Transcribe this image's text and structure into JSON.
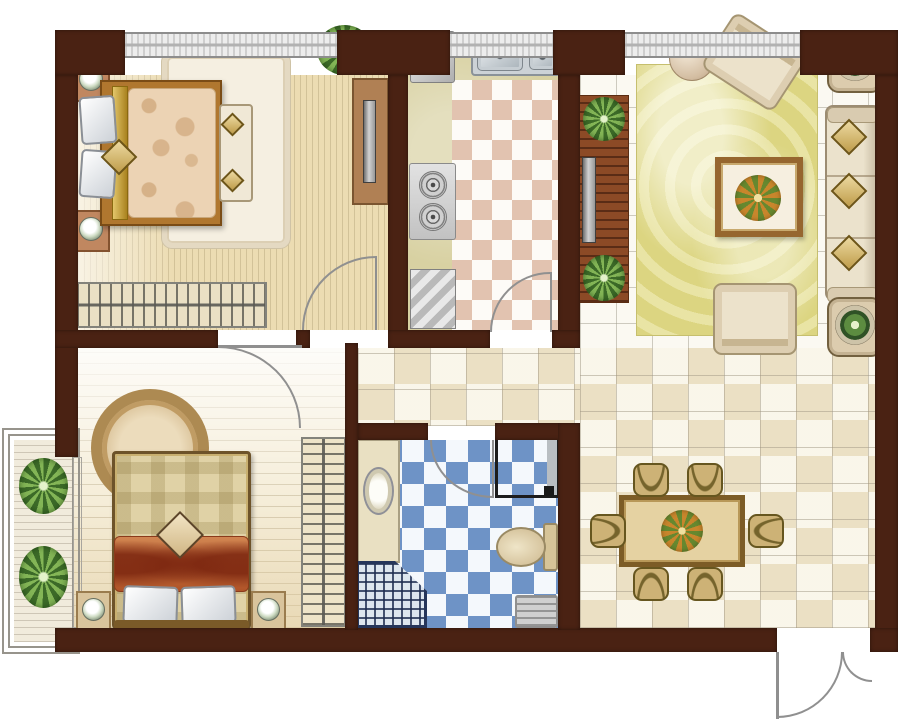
{
  "meta": {
    "name": "apartment-floor-plan",
    "canvas": {
      "width": 900,
      "height": 727
    },
    "background": "#ffffff"
  },
  "palette": {
    "wall": "#4a2213",
    "door_arc": "#909090",
    "tile_white": "#fbf9f2",
    "tile_warm": "#f7f2e3",
    "bath_tile_blue": "#6e93c6",
    "kitchen_tile_pink": "#e2c3b0",
    "wood_floor": "#ecdcb2",
    "living_rug_yellow": "#dcd581",
    "bed_wood": "#b0772f",
    "shelf_wood": "#8c4a26",
    "plant_green": "#83b556"
  },
  "rooms": [
    {
      "name": "bedroom-1",
      "position": "top-left"
    },
    {
      "name": "kitchen",
      "position": "top-middle"
    },
    {
      "name": "living-room",
      "position": "top-right"
    },
    {
      "name": "bedroom-2",
      "position": "bottom-left"
    },
    {
      "name": "bathroom",
      "position": "bottom-middle"
    },
    {
      "name": "dining-area",
      "position": "bottom-right"
    },
    {
      "name": "balcony",
      "position": "left"
    },
    {
      "name": "hallway",
      "position": "center"
    }
  ],
  "elements": [
    {
      "n": "bedroom1-floor",
      "c": "bed1-floor",
      "x": 78,
      "y": 75,
      "w": 310,
      "h": 255
    },
    {
      "n": "kitchen-counter-base",
      "c": "counter",
      "x": 408,
      "y": 58,
      "w": 150,
      "h": 272
    },
    {
      "n": "kitchen-floor",
      "c": "kitchen-floor",
      "x": 452,
      "y": 80,
      "w": 106,
      "h": 250
    },
    {
      "n": "living-room-floor",
      "c": "tiles",
      "x": 580,
      "y": 75,
      "w": 295,
      "h": 285
    },
    {
      "n": "hallway-floor",
      "c": "tiles-warm",
      "x": 358,
      "y": 348,
      "w": 224,
      "h": 78
    },
    {
      "n": "dining-floor",
      "c": "tiles-warm",
      "x": 580,
      "y": 348,
      "w": 295,
      "h": 280
    },
    {
      "n": "bedroom2-floor",
      "c": "bed2-floor",
      "x": 55,
      "y": 348,
      "w": 292,
      "h": 280
    },
    {
      "n": "bathroom-floor",
      "c": "bath-floor",
      "x": 358,
      "y": 440,
      "w": 200,
      "h": 188
    },
    {
      "n": "balcony-frame-outer",
      "c": "frame",
      "x": 2,
      "y": 428,
      "w": 78,
      "h": 226
    },
    {
      "n": "balcony-frame-inner",
      "c": "frame",
      "x": 8,
      "y": 434,
      "w": 66,
      "h": 214
    },
    {
      "n": "balcony-deck",
      "c": "deck",
      "x": 14,
      "y": 440,
      "w": 58,
      "h": 202
    },
    {
      "n": "balcony-window-line",
      "c": "frame-thin",
      "x": 73,
      "y": 457,
      "w": 9,
      "h": 171
    },
    {
      "n": "bedroom1-rug",
      "c": "rug-white",
      "x": 162,
      "y": 52,
      "w": 128,
      "h": 196
    },
    {
      "n": "living-room-rug",
      "c": "rug-lr",
      "x": 636,
      "y": 64,
      "w": 182,
      "h": 272
    },
    {
      "n": "bedroom2-round-rug",
      "c": "rug-round",
      "x": 91,
      "y": 389,
      "w": 118,
      "h": 118
    },
    {
      "n": "bedroom1-nightstand-top",
      "c": "nightstand",
      "x": 72,
      "y": 60,
      "w": 38,
      "h": 42
    },
    {
      "n": "bedroom1-lamp-top",
      "c": "lamp",
      "x": 79,
      "y": 67,
      "w": 24,
      "h": 24
    },
    {
      "n": "bedroom1-nightstand-bottom",
      "c": "nightstand",
      "x": 72,
      "y": 210,
      "w": 38,
      "h": 42
    },
    {
      "n": "bedroom1-lamp-bottom",
      "c": "lamp",
      "x": 79,
      "y": 217,
      "w": 24,
      "h": 24
    },
    {
      "n": "bedroom1-bed-frame",
      "c": "bed-frame",
      "x": 100,
      "y": 80,
      "w": 122,
      "h": 146
    },
    {
      "n": "bedroom1-bed-trim",
      "c": "gold",
      "x": 112,
      "y": 86,
      "w": 16,
      "h": 134
    },
    {
      "n": "bedroom1-duvet",
      "c": "duvet",
      "x": 128,
      "y": 88,
      "w": 88,
      "h": 130
    },
    {
      "n": "bedroom1-pillow-top",
      "c": "pillow",
      "x": 80,
      "y": 96,
      "w": 36,
      "h": 48,
      "r": -4
    },
    {
      "n": "bedroom1-pillow-bottom",
      "c": "pillow",
      "x": 80,
      "y": 150,
      "w": 36,
      "h": 48,
      "r": 4
    },
    {
      "n": "bedroom1-cushion",
      "c": "diamond",
      "x": 106,
      "y": 144,
      "w": 26,
      "h": 26,
      "r": 45
    },
    {
      "n": "bedroom1-bench",
      "c": "bench",
      "x": 219,
      "y": 104,
      "w": 34,
      "h": 98
    },
    {
      "n": "bedroom1-bench-cushion-top",
      "c": "diamond",
      "x": 224,
      "y": 116,
      "w": 17,
      "h": 17,
      "r": 45
    },
    {
      "n": "bedroom1-bench-cushion-bottom",
      "c": "diamond",
      "x": 224,
      "y": 172,
      "w": 17,
      "h": 17,
      "r": 45
    },
    {
      "n": "bedroom1-wardrobe",
      "c": "wardrobe-h",
      "x": 75,
      "y": 282,
      "w": 192,
      "h": 46
    },
    {
      "n": "bedroom1-plant",
      "c": "plant",
      "x": 317,
      "y": 25,
      "w": 55,
      "h": 50
    },
    {
      "n": "bedroom1-tv-console",
      "c": "console",
      "x": 352,
      "y": 78,
      "w": 37,
      "h": 127
    },
    {
      "n": "bedroom1-tv",
      "c": "tv",
      "x": 363,
      "y": 100,
      "w": 13,
      "h": 83
    },
    {
      "n": "kitchen-fridge",
      "c": "appliance",
      "x": 410,
      "y": 31,
      "w": 45,
      "h": 52
    },
    {
      "n": "kitchen-sink-unit",
      "c": "sink-unit",
      "x": 471,
      "y": 32,
      "w": 90,
      "h": 44
    },
    {
      "n": "kitchen-sink-basin-left",
      "c": "basin",
      "x": 477,
      "y": 37,
      "w": 46,
      "h": 34
    },
    {
      "n": "kitchen-sink-basin-right",
      "c": "basin",
      "x": 529,
      "y": 40,
      "w": 27,
      "h": 30
    },
    {
      "n": "kitchen-faucet",
      "c": "faucet",
      "x": 521,
      "y": 34,
      "w": 3,
      "h": 22
    },
    {
      "n": "kitchen-stove",
      "c": "stove",
      "x": 409,
      "y": 163,
      "w": 47,
      "h": 77
    },
    {
      "n": "kitchen-burner-top",
      "c": "burner",
      "x": 419,
      "y": 171,
      "w": 28,
      "h": 28
    },
    {
      "n": "kitchen-burner-bottom",
      "c": "burner",
      "x": 419,
      "y": 203,
      "w": 28,
      "h": 28
    },
    {
      "n": "kitchen-dishwasher",
      "c": "appliance-slant",
      "x": 410,
      "y": 269,
      "w": 46,
      "h": 60
    },
    {
      "n": "living-tv-shelf",
      "c": "tv-shelf",
      "x": 579,
      "y": 95,
      "w": 50,
      "h": 208
    },
    {
      "n": "living-shelf-plant-top",
      "c": "plant",
      "x": 583,
      "y": 97,
      "w": 42,
      "h": 44
    },
    {
      "n": "living-shelf-plant-bottom",
      "c": "plant",
      "x": 583,
      "y": 255,
      "w": 42,
      "h": 46
    },
    {
      "n": "living-tv",
      "c": "tv",
      "x": 582,
      "y": 157,
      "w": 14,
      "h": 86
    },
    {
      "n": "living-pouf",
      "c": "pouf",
      "x": 669,
      "y": 35,
      "w": 46,
      "h": 46
    },
    {
      "n": "living-armchair-top",
      "c": "armchair",
      "x": 711,
      "y": 29,
      "w": 86,
      "h": 66,
      "r": 33
    },
    {
      "n": "living-side-table-top",
      "c": "side-table",
      "x": 827,
      "y": 33,
      "w": 56,
      "h": 60
    },
    {
      "n": "living-side-table-top-plant",
      "c": "plant-pot",
      "x": 835,
      "y": 41,
      "w": 40,
      "h": 40
    },
    {
      "n": "living-sofa",
      "c": "sofa",
      "x": 825,
      "y": 105,
      "w": 56,
      "h": 196
    },
    {
      "n": "living-sofa-armrest-top",
      "c": "sofa-arm",
      "x": 827,
      "y": 107,
      "w": 52,
      "h": 16
    },
    {
      "n": "living-sofa-armrest-bottom",
      "c": "sofa-arm",
      "x": 827,
      "y": 287,
      "w": 52,
      "h": 16
    },
    {
      "n": "living-sofa-cushion-1",
      "c": "diamond",
      "x": 836,
      "y": 124,
      "w": 26,
      "h": 26,
      "r": 45
    },
    {
      "n": "living-sofa-cushion-2",
      "c": "diamond",
      "x": 836,
      "y": 178,
      "w": 26,
      "h": 26,
      "r": 45
    },
    {
      "n": "living-sofa-cushion-3",
      "c": "diamond",
      "x": 836,
      "y": 240,
      "w": 26,
      "h": 26,
      "r": 45
    },
    {
      "n": "living-coffee-table",
      "c": "coffee-table",
      "x": 715,
      "y": 157,
      "w": 88,
      "h": 80
    },
    {
      "n": "living-coffee-table-flowers",
      "c": "bouquet",
      "x": 735,
      "y": 175,
      "w": 46,
      "h": 46
    },
    {
      "n": "living-armchair-bottom",
      "c": "armchair",
      "x": 713,
      "y": 283,
      "w": 84,
      "h": 72,
      "r": 180
    },
    {
      "n": "living-side-table-bottom",
      "c": "side-table",
      "x": 827,
      "y": 297,
      "w": 56,
      "h": 60
    },
    {
      "n": "living-side-table-bottom-plant",
      "c": "plant-pot",
      "x": 835,
      "y": 305,
      "w": 40,
      "h": 40
    },
    {
      "n": "dining-table",
      "c": "table-dining",
      "x": 619,
      "y": 495,
      "w": 126,
      "h": 72
    },
    {
      "n": "dining-centerpiece",
      "c": "bouquet",
      "x": 661,
      "y": 510,
      "w": 42,
      "h": 42
    },
    {
      "n": "dining-chair-top-left",
      "c": "chair",
      "x": 633,
      "y": 463,
      "w": 36,
      "h": 34
    },
    {
      "n": "dining-chair-top-right",
      "c": "chair",
      "x": 687,
      "y": 463,
      "w": 36,
      "h": 34
    },
    {
      "n": "dining-chair-bottom-left",
      "c": "chair",
      "x": 633,
      "y": 567,
      "w": 36,
      "h": 34,
      "r": 180
    },
    {
      "n": "dining-chair-bottom-right",
      "c": "chair",
      "x": 687,
      "y": 567,
      "w": 36,
      "h": 34,
      "r": 180
    },
    {
      "n": "dining-chair-left",
      "c": "chair",
      "x": 591,
      "y": 513,
      "w": 34,
      "h": 36,
      "r": -90
    },
    {
      "n": "dining-chair-right",
      "c": "chair",
      "x": 749,
      "y": 513,
      "w": 34,
      "h": 36,
      "r": 90
    },
    {
      "n": "bedroom2-wardrobe",
      "c": "wardrobe-v",
      "x": 301,
      "y": 437,
      "w": 45,
      "h": 190
    },
    {
      "n": "bedroom2-bed-frame",
      "c": "bed2-frame",
      "x": 112,
      "y": 451,
      "w": 139,
      "h": 178
    },
    {
      "n": "bedroom2-bed-body",
      "c": "bed2-body",
      "x": 117,
      "y": 456,
      "w": 129,
      "h": 168
    },
    {
      "n": "bedroom2-blanket",
      "c": "blanket",
      "x": 114,
      "y": 536,
      "w": 135,
      "h": 56
    },
    {
      "n": "bedroom2-cushion",
      "c": "diamond-cream",
      "x": 163,
      "y": 518,
      "w": 34,
      "h": 34,
      "r": 45
    },
    {
      "n": "bedroom2-pillow-left",
      "c": "pillow",
      "x": 123,
      "y": 586,
      "w": 55,
      "h": 38,
      "r": 2
    },
    {
      "n": "bedroom2-pillow-right",
      "c": "pillow",
      "x": 181,
      "y": 586,
      "w": 55,
      "h": 38,
      "r": -2
    },
    {
      "n": "bedroom2-headboard",
      "c": "headboard",
      "x": 114,
      "y": 620,
      "w": 135,
      "h": 9
    },
    {
      "n": "bedroom2-nightstand-left",
      "c": "nightstand-light",
      "x": 76,
      "y": 591,
      "w": 35,
      "h": 39
    },
    {
      "n": "bedroom2-lamp-left",
      "c": "lamp",
      "x": 82,
      "y": 598,
      "w": 23,
      "h": 23
    },
    {
      "n": "bedroom2-nightstand-right",
      "c": "nightstand-light",
      "x": 251,
      "y": 591,
      "w": 35,
      "h": 39
    },
    {
      "n": "bedroom2-lamp-right",
      "c": "lamp",
      "x": 257,
      "y": 598,
      "w": 23,
      "h": 23
    },
    {
      "n": "balcony-plant-top",
      "c": "plant",
      "x": 19,
      "y": 458,
      "w": 49,
      "h": 56
    },
    {
      "n": "balcony-plant-bottom",
      "c": "plant",
      "x": 19,
      "y": 546,
      "w": 49,
      "h": 62
    },
    {
      "n": "bathroom-vanity",
      "c": "vanity",
      "x": 357,
      "y": 439,
      "w": 43,
      "h": 124
    },
    {
      "n": "bathroom-sink",
      "c": "oval",
      "x": 363,
      "y": 467,
      "w": 31,
      "h": 48
    },
    {
      "n": "bathroom-shower",
      "c": "shower",
      "x": 356,
      "y": 561,
      "w": 71,
      "h": 67
    },
    {
      "n": "bathroom-washing-machine",
      "c": "washer",
      "x": 495,
      "y": 437,
      "w": 65,
      "h": 61
    },
    {
      "n": "bathroom-washer-knob",
      "c": "dot",
      "x": 544,
      "y": 486,
      "w": 10,
      "h": 10
    },
    {
      "n": "bathroom-toilet-cistern",
      "c": "cistern",
      "x": 543,
      "y": 523,
      "w": 15,
      "h": 48
    },
    {
      "n": "bathroom-toilet",
      "c": "toilet",
      "x": 496,
      "y": 527,
      "w": 50,
      "h": 40
    },
    {
      "n": "bathroom-mat",
      "c": "mat",
      "x": 515,
      "y": 595,
      "w": 43,
      "h": 33
    },
    {
      "n": "wall-top-corner-left",
      "c": "wall",
      "x": 55,
      "y": 30,
      "w": 70,
      "h": 45
    },
    {
      "n": "wall-top-pier-1",
      "c": "wall",
      "x": 337,
      "y": 30,
      "w": 113,
      "h": 45
    },
    {
      "n": "wall-top-pier-2",
      "c": "wall",
      "x": 553,
      "y": 30,
      "w": 72,
      "h": 45
    },
    {
      "n": "wall-top-corner-right",
      "c": "wall",
      "x": 800,
      "y": 30,
      "w": 98,
      "h": 45
    },
    {
      "n": "wall-left",
      "c": "wall",
      "x": 55,
      "y": 75,
      "w": 23,
      "h": 382
    },
    {
      "n": "wall-right",
      "c": "wall",
      "x": 875,
      "y": 75,
      "w": 23,
      "h": 577
    },
    {
      "n": "wall-bottom",
      "c": "wall",
      "x": 55,
      "y": 628,
      "w": 722,
      "h": 24
    },
    {
      "n": "wall-bottom-right-corner",
      "c": "wall",
      "x": 870,
      "y": 628,
      "w": 28,
      "h": 24
    },
    {
      "n": "wall-bedroom1-kitchen",
      "c": "wall",
      "x": 388,
      "y": 75,
      "w": 20,
      "h": 273
    },
    {
      "n": "wall-kitchen-living",
      "c": "wall",
      "x": 558,
      "y": 75,
      "w": 22,
      "h": 273
    },
    {
      "n": "wall-bedroom1-bedroom2",
      "c": "wall",
      "x": 55,
      "y": 330,
      "w": 163,
      "h": 18
    },
    {
      "n": "wall-jamb-mid",
      "c": "wall",
      "x": 296,
      "y": 330,
      "w": 14,
      "h": 18
    },
    {
      "n": "wall-kitchen-bottom-left",
      "c": "wall",
      "x": 388,
      "y": 330,
      "w": 102,
      "h": 18
    },
    {
      "n": "wall-kitchen-bottom-right",
      "c": "wall",
      "x": 552,
      "y": 330,
      "w": 28,
      "h": 18
    },
    {
      "n": "wall-bedroom2-bathroom",
      "c": "wall",
      "x": 345,
      "y": 343,
      "w": 13,
      "h": 287
    },
    {
      "n": "wall-bathroom-top-left",
      "c": "wall",
      "x": 358,
      "y": 423,
      "w": 70,
      "h": 17
    },
    {
      "n": "wall-bathroom-top-right",
      "c": "wall",
      "x": 495,
      "y": 423,
      "w": 85,
      "h": 17
    },
    {
      "n": "wall-bathroom-right",
      "c": "wall",
      "x": 558,
      "y": 423,
      "w": 22,
      "h": 207
    },
    {
      "n": "window-bedroom1",
      "c": "window",
      "x": 125,
      "y": 32,
      "w": 212,
      "h": 26
    },
    {
      "n": "window-kitchen",
      "c": "window",
      "x": 450,
      "y": 32,
      "w": 103,
      "h": 26
    },
    {
      "n": "window-living-room",
      "c": "window",
      "x": 625,
      "y": 32,
      "w": 175,
      "h": 26
    },
    {
      "n": "door-bedroom1-leaf",
      "c": "leaf",
      "x": 375,
      "y": 256,
      "w": 2,
      "h": 74
    },
    {
      "n": "door-bedroom1-swing",
      "c": "arc-tl",
      "x": 302,
      "y": 256,
      "w": 74,
      "h": 74
    },
    {
      "n": "door-bedroom2-leaf",
      "c": "leaf",
      "x": 218,
      "y": 345,
      "w": 84,
      "h": 3
    },
    {
      "n": "door-bedroom2-swing",
      "c": "arc-tr",
      "x": 218,
      "y": 346,
      "w": 83,
      "h": 82
    },
    {
      "n": "door-kitchen-leaf",
      "c": "leaf",
      "x": 550,
      "y": 272,
      "w": 2,
      "h": 60
    },
    {
      "n": "door-kitchen-swing",
      "c": "arc-tl",
      "x": 490,
      "y": 272,
      "w": 60,
      "h": 60
    },
    {
      "n": "door-bathroom-leaf",
      "c": "leaf",
      "x": 492,
      "y": 440,
      "w": 2,
      "h": 58
    },
    {
      "n": "door-bathroom-swing",
      "c": "arc-bl",
      "x": 430,
      "y": 440,
      "w": 63,
      "h": 58
    },
    {
      "n": "door-entry-leaf",
      "c": "leaf",
      "x": 776,
      "y": 652,
      "w": 3,
      "h": 67
    },
    {
      "n": "door-entry-swing",
      "c": "arc-br",
      "x": 777,
      "y": 652,
      "w": 66,
      "h": 66
    },
    {
      "n": "door-entry-swing-small",
      "c": "arc-bl",
      "x": 842,
      "y": 652,
      "w": 30,
      "h": 30
    }
  ]
}
